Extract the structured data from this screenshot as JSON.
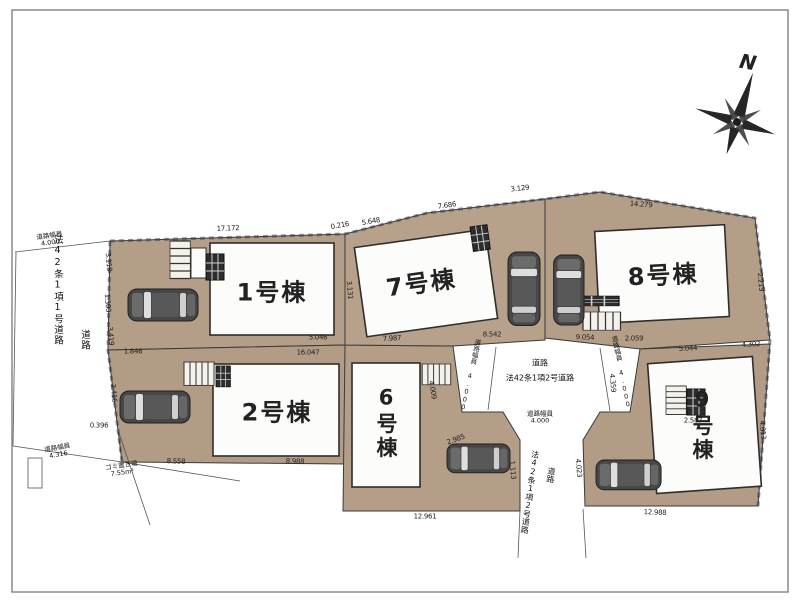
{
  "compass": {
    "north_label": "N"
  },
  "buildings": [
    {
      "label": "1号棟"
    },
    {
      "label": "2号棟"
    },
    {
      "label": "6号棟"
    },
    {
      "label": "7号棟"
    },
    {
      "label": "8号棟"
    },
    {
      "label": "9号棟"
    }
  ],
  "roads": {
    "left": {
      "name": "法42条1項1号道路",
      "type_label": "道路",
      "width_top_label": "道路幅員",
      "width_top_value": "4.000",
      "width_bottom_label": "道路幅員",
      "width_bottom_value": "4.316"
    },
    "center": {
      "type_label": "道路",
      "name": "法42条1項2号道路",
      "width_label": "道路幅員",
      "width_value": "4.000",
      "flare_left_label": "道路幅員 4.000",
      "flare_right_label": "道路幅員 4.000"
    },
    "south": {
      "name": "法42条1項2号道路",
      "type_label": "道路"
    }
  },
  "garbage": {
    "label": "ゴミ置き場",
    "area": "7.55m²"
  },
  "dimensions": [
    {
      "t": "17.172",
      "x": 228,
      "y": 229,
      "r": -2
    },
    {
      "t": "0.216",
      "x": 340,
      "y": 226,
      "r": -10
    },
    {
      "t": "5.648",
      "x": 371,
      "y": 222,
      "r": -10
    },
    {
      "t": "7.686",
      "x": 447,
      "y": 206,
      "r": -8
    },
    {
      "t": "3.129",
      "x": 520,
      "y": 189,
      "r": -6
    },
    {
      "t": "14.279",
      "x": 641,
      "y": 205,
      "r": 4
    },
    {
      "t": "5.046",
      "x": 318,
      "y": 338,
      "r": 0
    },
    {
      "t": "1.846",
      "x": 133,
      "y": 352,
      "r": 0
    },
    {
      "t": "16.047",
      "x": 308,
      "y": 353,
      "r": 0
    },
    {
      "t": "7.987",
      "x": 392,
      "y": 339,
      "r": -3
    },
    {
      "t": "8.542",
      "x": 492,
      "y": 335,
      "r": 0
    },
    {
      "t": "9.054",
      "x": 585,
      "y": 338,
      "r": 2
    },
    {
      "t": "2.059",
      "x": 634,
      "y": 339,
      "r": 0
    },
    {
      "t": "5.044",
      "x": 688,
      "y": 349,
      "r": -3
    },
    {
      "t": "4.302",
      "x": 751,
      "y": 345,
      "r": -3
    },
    {
      "t": "8.558",
      "x": 176,
      "y": 462,
      "r": 2
    },
    {
      "t": "8.988",
      "x": 295,
      "y": 462,
      "r": 2
    },
    {
      "t": "12.961",
      "x": 425,
      "y": 517,
      "r": 0
    },
    {
      "t": "12.988",
      "x": 655,
      "y": 513,
      "r": 2
    },
    {
      "t": "0.396",
      "x": 99,
      "y": 426,
      "r": 0
    },
    {
      "t": "3.118",
      "x": 108,
      "y": 262,
      "r": 85
    },
    {
      "t": "1.303",
      "x": 107,
      "y": 303,
      "r": 85
    },
    {
      "t": "3.419",
      "x": 110,
      "y": 336,
      "r": 85
    },
    {
      "t": "2.416",
      "x": 113,
      "y": 393,
      "r": 85
    },
    {
      "t": "3.131",
      "x": 349,
      "y": 290,
      "r": 85
    },
    {
      "t": "2.213",
      "x": 760,
      "y": 282,
      "r": 85
    },
    {
      "t": "4.813",
      "x": 762,
      "y": 430,
      "r": 85
    },
    {
      "t": "4.009",
      "x": 432,
      "y": 390,
      "r": 80
    },
    {
      "t": "2.985",
      "x": 456,
      "y": 440,
      "r": -20
    },
    {
      "t": "1.113",
      "x": 512,
      "y": 470,
      "r": 85
    },
    {
      "t": "4.023",
      "x": 578,
      "y": 468,
      "r": 85
    },
    {
      "t": "2.587",
      "x": 693,
      "y": 421,
      "r": 0
    },
    {
      "t": "4.359",
      "x": 612,
      "y": 383,
      "r": 85
    }
  ],
  "colors": {
    "lot_fill": "#b49e88",
    "building_fill": "#fcfcfa",
    "line": "#3a3a3a",
    "tick": "#3d4252",
    "car_body": "#474747"
  }
}
